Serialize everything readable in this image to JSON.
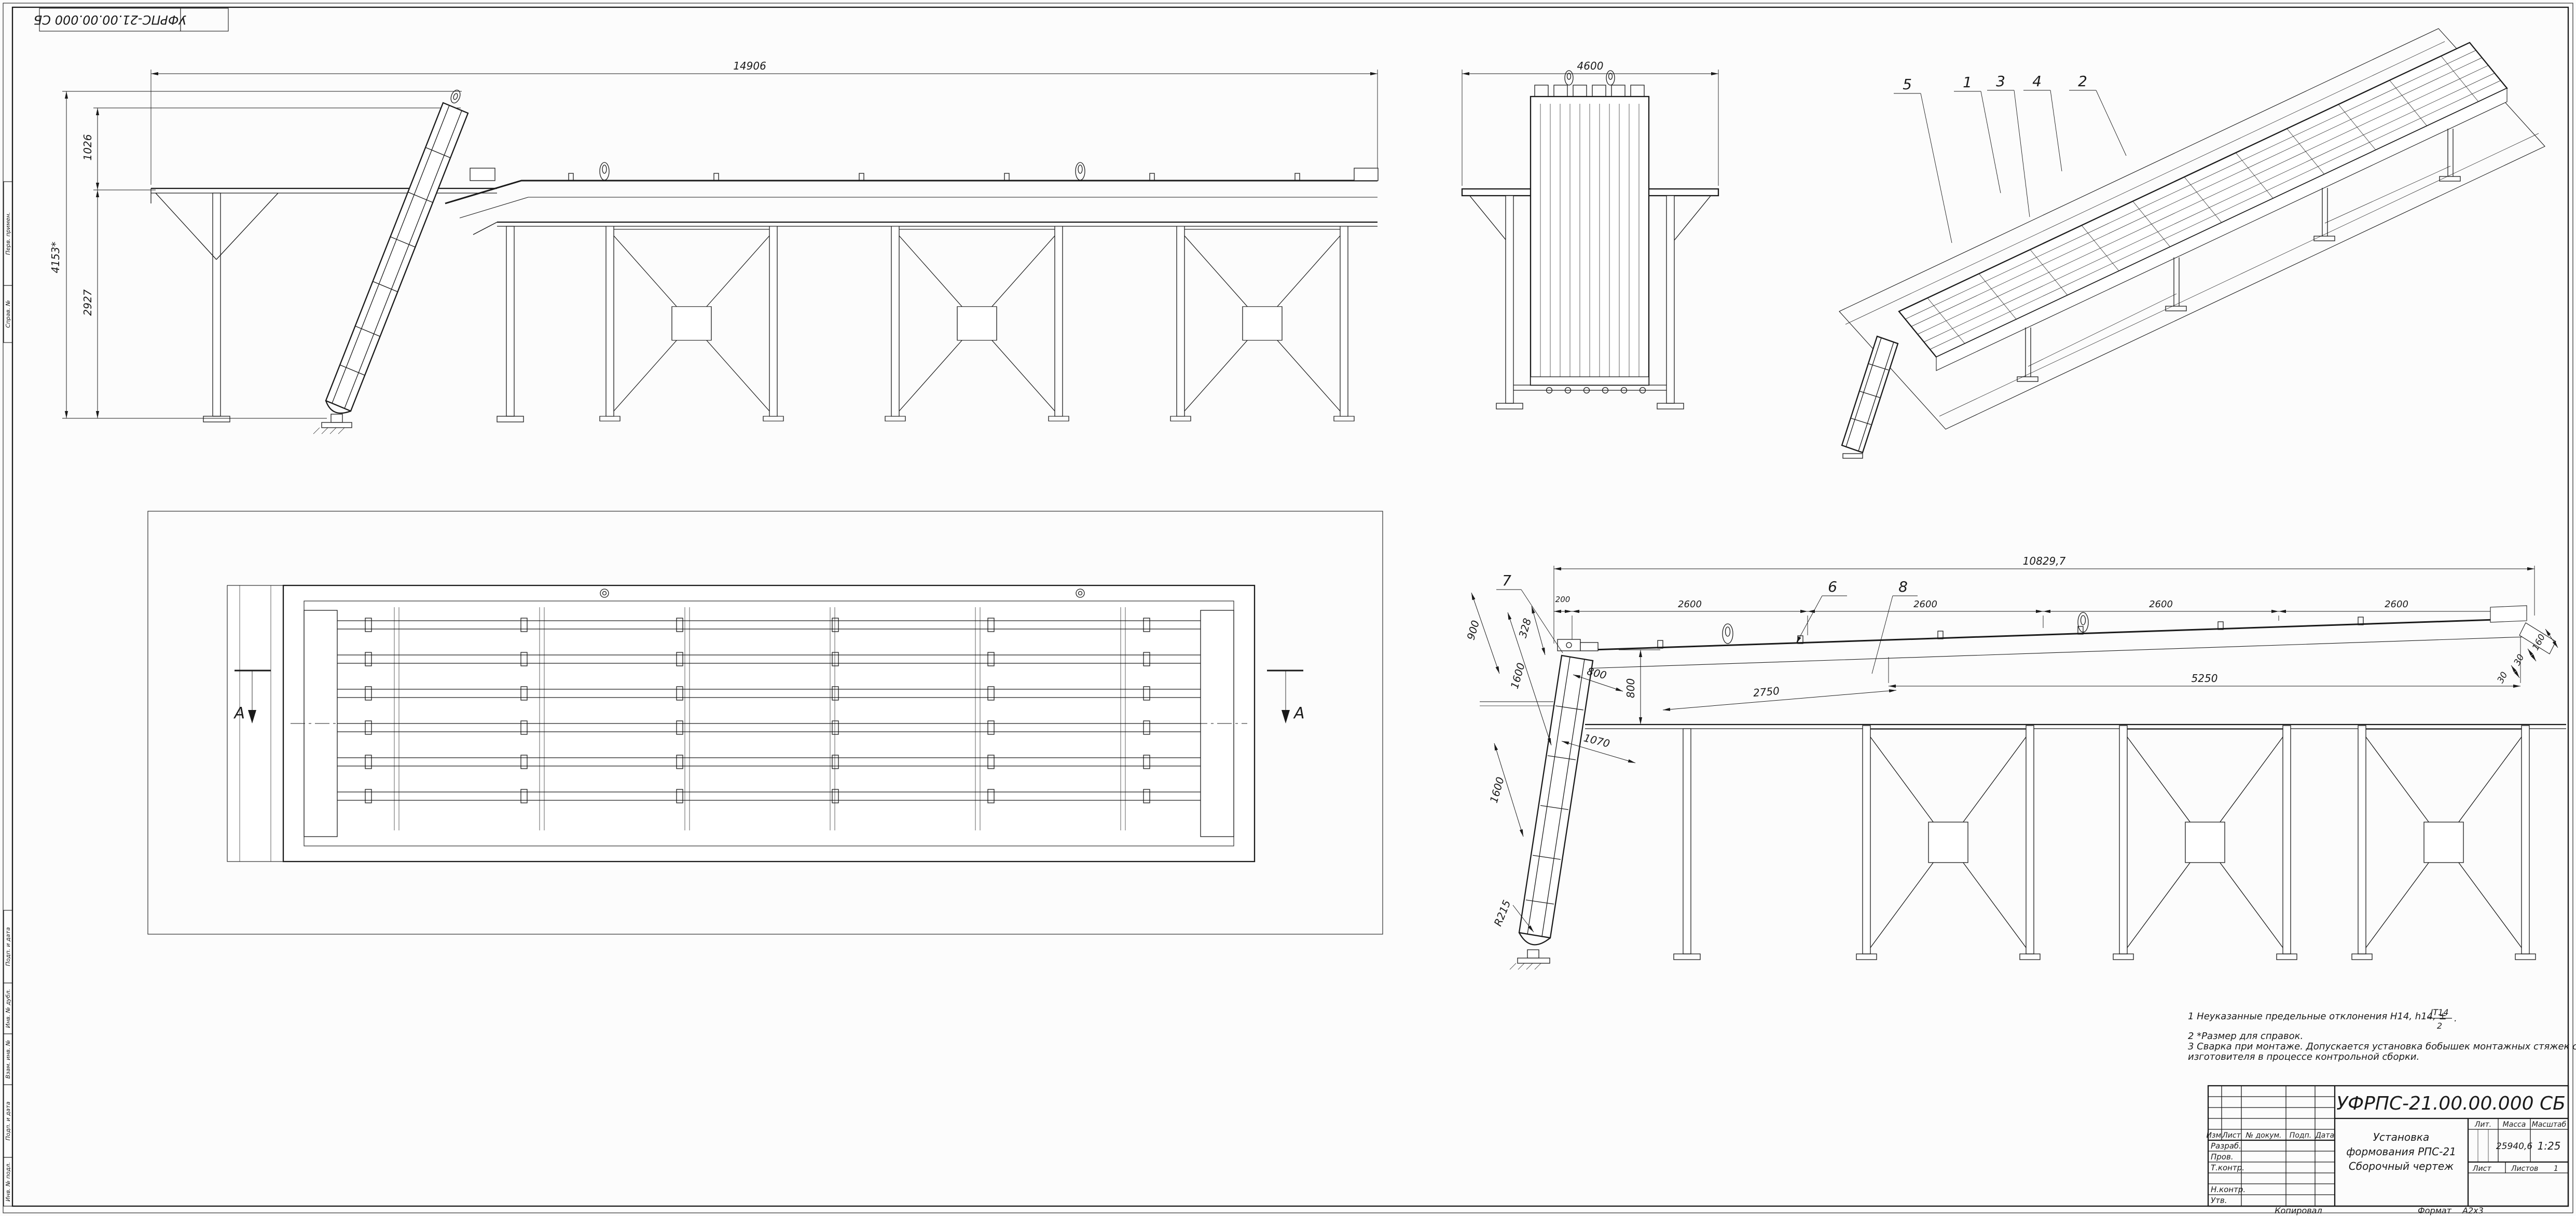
{
  "sheet": {
    "corner_stamp": "УФРПС-21.00.00.000 СБ",
    "margin_stamps": {
      "perv_primen": "Перв. примен.",
      "sprav_no": "Справ. №",
      "podp_data_1": "Подп. и дата",
      "inv_dubl": "Инв. № дубл.",
      "vzam_inv": "Взам. инв. №",
      "podp_data_2": "Подп. и дата",
      "inv_podl": "Инв. № подл."
    }
  },
  "views": {
    "side": {
      "dim_overall": "14906",
      "dim_height_total": "4153*",
      "dim_height_upper": "1026",
      "dim_height_lower": "2927"
    },
    "front": {
      "dim_width": "4600"
    },
    "iso": {
      "callouts": [
        "5",
        "1",
        "3",
        "4",
        "2"
      ]
    },
    "plan": {
      "section_left": "А",
      "section_right": "А"
    },
    "detail": {
      "dim_overall": "10829,7",
      "seg_200": "200",
      "seg_2600_1": "2600",
      "seg_2600_2": "2600",
      "seg_2600_3": "2600",
      "seg_2600_4": "2600",
      "dim_5250": "5250",
      "dim_800_vert": "800",
      "dim_2750": "2750",
      "dim_900": "900",
      "dim_328": "328",
      "dim_1600_a": "1600",
      "dim_800_incline": "800",
      "dim_1070": "1070",
      "dim_1600_b": "1600",
      "dim_r215": "R215",
      "dim_30_a": "30",
      "dim_30_b": "30",
      "dim_160": "160",
      "callout_7": "7",
      "callout_6": "6",
      "callout_8": "8"
    }
  },
  "notes": {
    "n1_a": "1  Неуказанные предельные отклонения Н14, h14,  ±",
    "n1_frac_num": "IT14",
    "n1_frac_den": "2",
    "n1_b": ".",
    "n2": "2  *Размер для справок.",
    "n3_a": "3  Сварка при монтаже. Допускается установка бобышек монтажных стяжек силами предприятия",
    "n3_b": "изготовителя в процессе контрольной сборки."
  },
  "titleblock": {
    "doc_number": "УФРПС-21.00.00.000 СБ",
    "rev_cols": {
      "izm": "Изм.",
      "list": "Лист",
      "doc": "№ докум.",
      "podp": "Подп.",
      "data": "Дата"
    },
    "rows": {
      "razrab": "Разраб.",
      "prov": "Пров.",
      "tkontr": "Т.контр.",
      "nkontr": "Н.контр.",
      "utv": "Утв."
    },
    "lit_label": "Лит.",
    "mass_label": "Масса",
    "scale_label": "Масштаб",
    "mass_value": "25940,6",
    "scale_value": "1:25",
    "name_line1": "Установка",
    "name_line2": "формования РПС-21",
    "name_line3": "Сборочный чертеж",
    "sheet_label": "Лист",
    "sheets_label": "Листов",
    "sheets_value": "1",
    "copied_by": "Копировал",
    "format_label": "Формат",
    "format_value": "А2х3"
  }
}
